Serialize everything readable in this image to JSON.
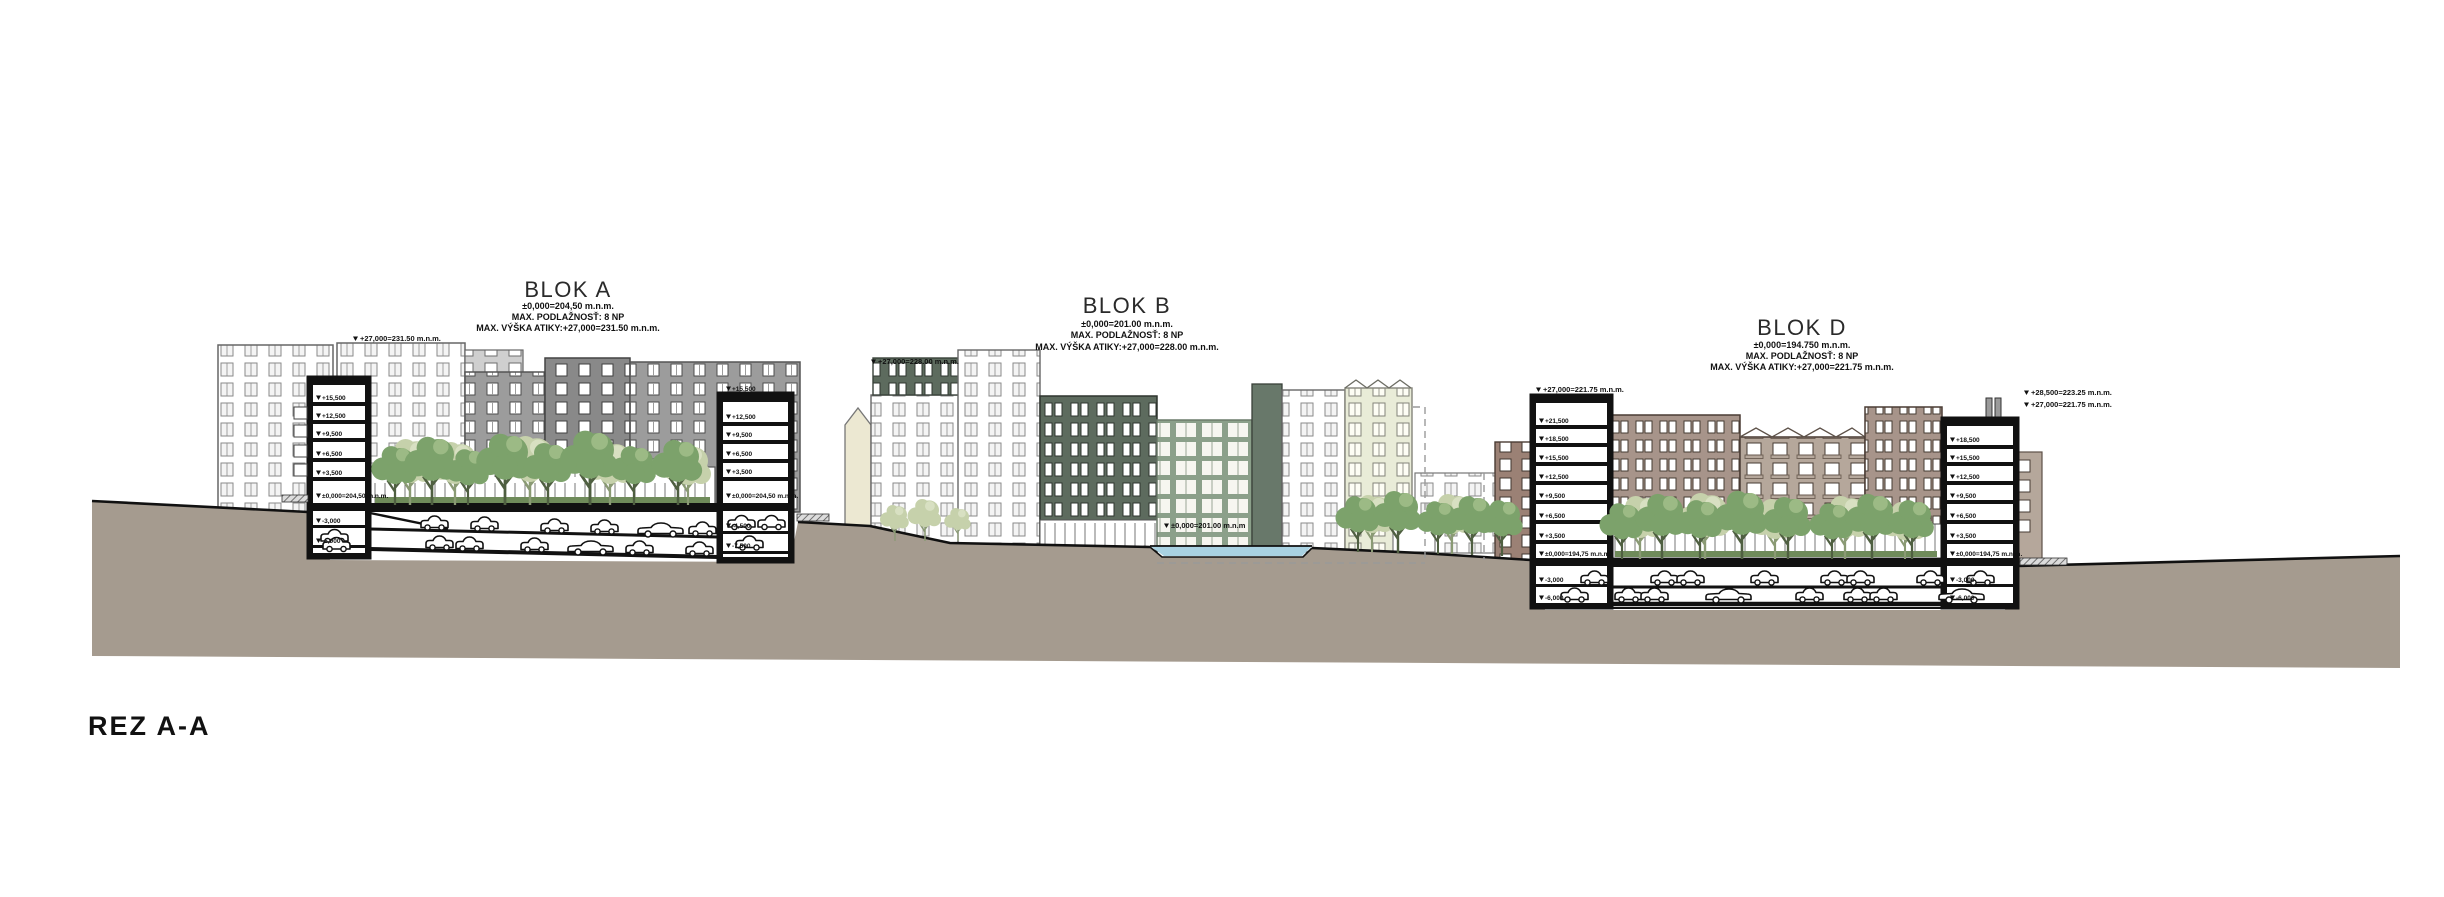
{
  "drawing_title": {
    "label": "REZ A-A"
  },
  "blocks": [
    {
      "title": "BLOK A",
      "zero": "±0,000=204,50 m.n.m.",
      "storeys": "MAX. PODLAŽNOSŤ: 8 NP",
      "attic": "MAX. VÝŠKA ATIKY:+27,000=231.50 m.n.m."
    },
    {
      "title": "BLOK B",
      "zero": "±0,000=201.00 m.n.m.",
      "storeys": "MAX. PODLAŽNOSŤ: 8 NP",
      "attic": "MAX. VÝŠKA ATIKY:+27,000=228.00 m.n.m."
    },
    {
      "title": "BLOK D",
      "zero": "±0,000=194.750 m.n.m.",
      "storeys": "MAX. PODLAŽNOSŤ: 8 NP",
      "attic": "MAX. VÝŠKA ATIKY:+27,000=221.75 m.n.m."
    }
  ],
  "annotations": {
    "a_attic": "+27,000=231.50 m.n.m.",
    "b_attic": "+27,000=228.00 m.n.m.",
    "b_zero": "±0,000=201.00 m.n.m",
    "d_left_attic": "+27,000=221.75 m.n.m.",
    "d_right_upper": "+28,500=223.25 m.n.m.",
    "d_right_lower": "+27,000=221.75 m.n.m."
  },
  "towers": {
    "a_left": {
      "levels": [
        "+18,500",
        "+15,500",
        "+12,500",
        "+9,500",
        "+6,500",
        "+3,500",
        "±0,000=204,50 m.n.m.",
        "-3,000",
        "-6,000"
      ]
    },
    "a_right": {
      "levels": [
        "+15,500",
        "+12,500",
        "+9,500",
        "+6,500",
        "+3,500",
        "±0,000=204,50 m.n.m.",
        "-4,500",
        "-7,500"
      ]
    },
    "d_left": {
      "levels": [
        "+21,500",
        "+18,500",
        "+15,500",
        "+12,500",
        "+9,500",
        "+6,500",
        "+3,500",
        "±0,000=194,75 m.n.m.",
        "-3,000",
        "-6,000"
      ]
    },
    "d_right": {
      "levels": [
        "+18,500",
        "+15,500",
        "+12,500",
        "+9,500",
        "+6,500",
        "+3,500",
        "±0,000=194,75 m.n.m.",
        "-3,000",
        "-6,000"
      ]
    }
  },
  "colors": {
    "terrain": "#a59b8f",
    "water": "#a9d2e2",
    "ink": "#111111",
    "tree_green": "#7ca26b",
    "tree_pale": "#c6d1ab",
    "hedge": "#6f8b5a",
    "gray_facade": "#9c9c9c",
    "dark_gray_facade": "#898989",
    "light_gray_facade": "#cfcfcf",
    "dark_green_facade": "#5d6b5e",
    "sage_facade": "#8ba08a",
    "pale_green_facade": "#e9ecd8",
    "cream_facade": "#ece8d2",
    "mauve_facade": "#a7948a",
    "mauve_light_facade": "#b5a79b",
    "red_brown_facade": "#9b8175"
  }
}
